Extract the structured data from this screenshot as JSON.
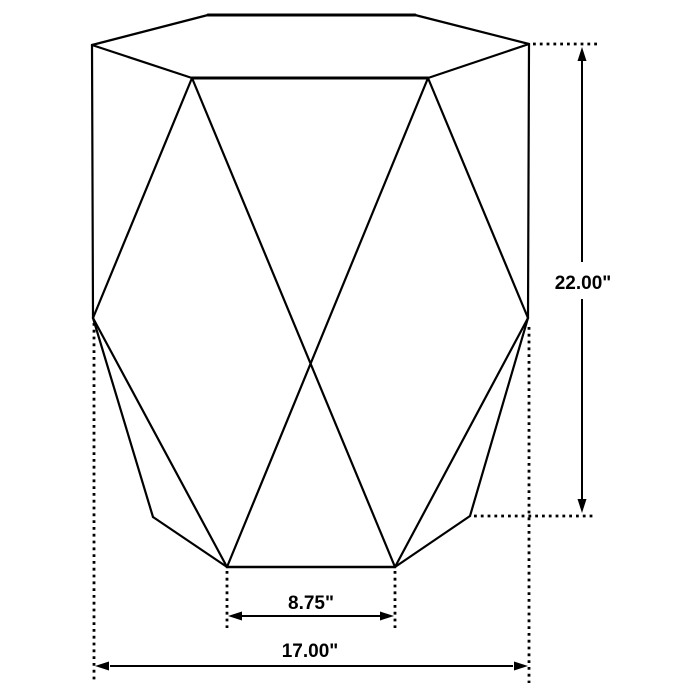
{
  "diagram": {
    "subject": "faceted hexagonal accent table line drawing with dimensions"
  },
  "colors": {
    "line": "#000000",
    "background": "#ffffff",
    "text": "#000000"
  },
  "dimensions": {
    "height": {
      "label": "22.00\"",
      "value": 22.0,
      "unit": "in"
    },
    "base_front_width": {
      "label": "8.75\"",
      "value": 8.75,
      "unit": "in"
    },
    "overall_width": {
      "label": "17.00\"",
      "value": 17.0,
      "unit": "in"
    }
  }
}
